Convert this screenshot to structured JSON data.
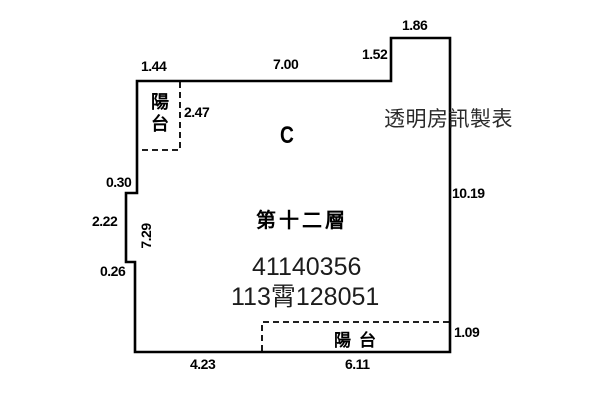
{
  "page": {
    "background": "#ffffff",
    "line_color": "#000000",
    "text_color": "#000000"
  },
  "plan": {
    "unit_label": "C",
    "floor_label": "第十二層",
    "id_number": "41140356",
    "registration_number": "113霄128051",
    "watermark": "透明房訊製表",
    "balcony_top_left_label": "陽台",
    "balcony_bottom_right_label": "陽台",
    "dimensions": {
      "top_balcony_width": "1.44",
      "top_main_width": "7.00",
      "top_right_step_height": "1.52",
      "top_right_notch_width": "1.86",
      "top_left_balcony_depth": "2.47",
      "left_step_out": "0.30",
      "left_notch_height": "2.22",
      "left_step_in": "0.26",
      "left_interior_height": "7.29",
      "right_height": "10.19",
      "bottom_right_balcony_depth": "1.09",
      "bottom_left_width": "4.23",
      "bottom_balcony_width": "6.11"
    }
  }
}
